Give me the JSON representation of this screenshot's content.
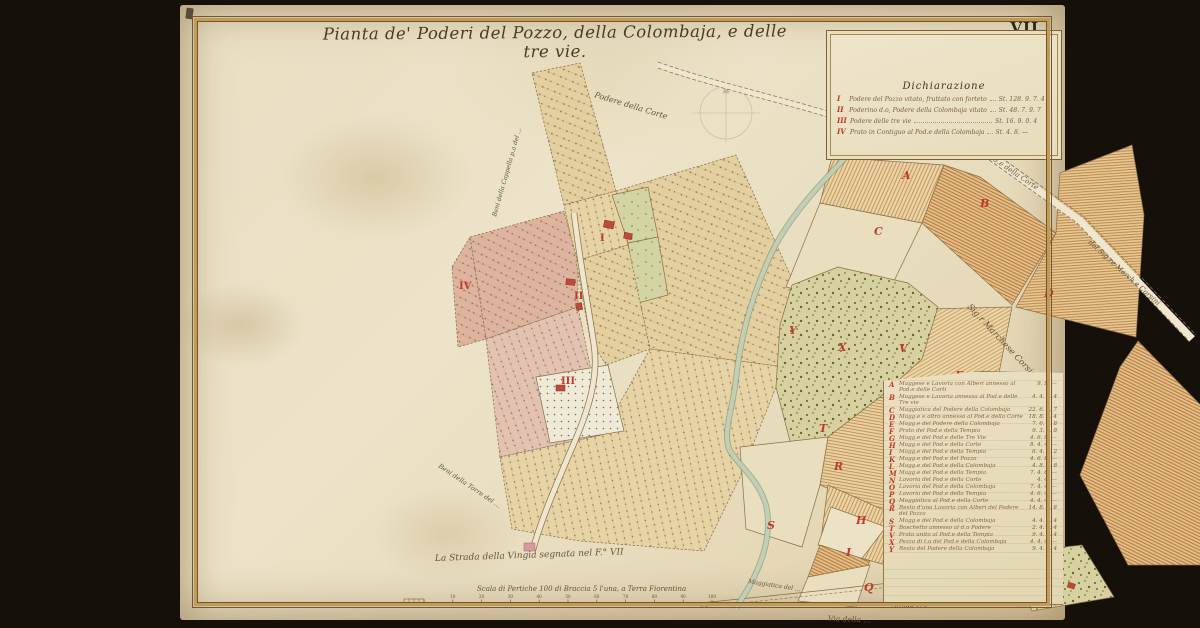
{
  "sheet": {
    "number": "VII",
    "title": "Pianta de' Poderi del Pozzo, della Colombaja, e delle tre vie."
  },
  "legend": {
    "title": "Dichiarazione",
    "entries": [
      {
        "numeral": "I",
        "text": "Podere del Pozzo vitato, fruttato con forteto &.",
        "value": "St. 128. 9. 7. 4"
      },
      {
        "numeral": "II",
        "text": "Poderino d.o, Podere della Colombaja vitato &.",
        "value": "St. 48. 7. 9. 7"
      },
      {
        "numeral": "III",
        "text": "Podere delle tre vie",
        "value": "St. 16. 9. 0. 4"
      },
      {
        "numeral": "IV",
        "text": "Prato in Contiguo al Pod.e della Colombaja",
        "value": "St. 4. 8. —"
      }
    ]
  },
  "index": {
    "entries": [
      {
        "letter": "A",
        "text": "Maggese e Lavoria con Alberi annesso al Pod.e delle Corti",
        "value": "9. 9. —"
      },
      {
        "letter": "B",
        "text": "Maggese e Lavoria annessa al Pod.e delle Tre vie",
        "value": "4. 4. 8. 4"
      },
      {
        "letter": "C",
        "text": "Maggiatica del Podere della Colombaja",
        "value": "22. 6. 2. 7"
      },
      {
        "letter": "D",
        "text": "Magg.e e altro annesso al Pod.e della Corte",
        "value": "18. 8. 6. 4"
      },
      {
        "letter": "E",
        "text": "Magg.e del Podere della Colombaja",
        "value": "7. 6. 8. 8"
      },
      {
        "letter": "F",
        "text": "Prato del Pod.e della Tempia",
        "value": "9. 3. 4. 8"
      },
      {
        "letter": "G",
        "text": "Magg.e del Pod.e delle Tre Vie",
        "value": "4. 6. 9. —"
      },
      {
        "letter": "H",
        "text": "Magg.e del Pod.e della Corte",
        "value": "8. 4. 4. —"
      },
      {
        "letter": "I",
        "text": "Magg.e del Pod.e della Tempia",
        "value": "6. 4. 2. 2"
      },
      {
        "letter": "K",
        "text": "Magg.e del Pod.e del Pozzo",
        "value": "4. 6. 8. —"
      },
      {
        "letter": "L",
        "text": "Magg.e del Pod.e della Colombaja",
        "value": "4. 8. 4. 8"
      },
      {
        "letter": "M",
        "text": "Magg.e del Pod.e della Tempia",
        "value": "7. 4. 6. —"
      },
      {
        "letter": "N",
        "text": "Lavoria del Pod.e della Corte",
        "value": "4. 4. —"
      },
      {
        "letter": "O",
        "text": "Lavoria del Pod.e della Colombaja",
        "value": "7. 4. 4. —"
      },
      {
        "letter": "P",
        "text": "Lavoria del Pod.e della Tempia",
        "value": "4. 6. 4. —"
      },
      {
        "letter": "Q",
        "text": "Maggiatica al Pod.e della Corte",
        "value": "4. 4. 4. —"
      },
      {
        "letter": "R",
        "text": "Resto d'una Lavoria con Alberi del Podere del Pozzo",
        "value": "14. 8. 9. 8"
      },
      {
        "letter": "S",
        "text": "Magg.e del Pod.e della Colombaja",
        "value": "4. 4. 4. 4"
      },
      {
        "letter": "T",
        "text": "Boschetto annesso al d.o Podere",
        "value": "2. 4. 4. 4"
      },
      {
        "letter": "V",
        "text": "Prato unito al Pod.e della Tempia",
        "value": "9. 4. 4. 4"
      },
      {
        "letter": "X",
        "text": "Pezzo di t.a del Pod.e della Colombaja",
        "value": "4. 4. 4. —"
      },
      {
        "letter": "Y",
        "text": "Resto del Podere della Colombaja",
        "value": "9. 4. 6. 4"
      }
    ]
  },
  "map": {
    "letters": [
      {
        "ch": "A",
        "x": 722,
        "y": 174
      },
      {
        "ch": "B",
        "x": 800,
        "y": 202
      },
      {
        "ch": "C",
        "x": 694,
        "y": 230
      },
      {
        "ch": "D",
        "x": 864,
        "y": 292
      },
      {
        "ch": "E",
        "x": 775,
        "y": 374
      },
      {
        "ch": "F",
        "x": 746,
        "y": 430
      },
      {
        "ch": "G",
        "x": 704,
        "y": 482
      },
      {
        "ch": "H",
        "x": 676,
        "y": 519
      },
      {
        "ch": "I",
        "x": 666,
        "y": 551
      },
      {
        "ch": "K",
        "x": 832,
        "y": 516
      },
      {
        "ch": "L",
        "x": 814,
        "y": 536
      },
      {
        "ch": "M",
        "x": 758,
        "y": 529
      },
      {
        "ch": "Q",
        "x": 684,
        "y": 586
      },
      {
        "ch": "R",
        "x": 654,
        "y": 465
      },
      {
        "ch": "S",
        "x": 587,
        "y": 524
      },
      {
        "ch": "T",
        "x": 639,
        "y": 427
      },
      {
        "ch": "V",
        "x": 719,
        "y": 347
      },
      {
        "ch": "X",
        "x": 658,
        "y": 346
      },
      {
        "ch": "Y",
        "x": 609,
        "y": 329
      }
    ],
    "numerals": [
      {
        "ch": "I",
        "x": 420,
        "y": 236,
        "size": 10
      },
      {
        "ch": "II",
        "x": 394,
        "y": 294,
        "size": 10
      },
      {
        "ch": "III",
        "x": 381,
        "y": 379,
        "size": 10
      },
      {
        "ch": "IV",
        "x": 279,
        "y": 284,
        "size": 8
      }
    ],
    "labels": [
      {
        "text": "Podere della Corte",
        "x": 414,
        "y": 92,
        "rot": 17,
        "size": 8
      },
      {
        "text": "Beni della Cappella p.a del …",
        "x": 316,
        "y": 212,
        "rot": -74,
        "size": 6.2
      },
      {
        "text": "Ansano",
        "x": 697,
        "y": 118,
        "rot": -62,
        "size": 6
      },
      {
        "text": "Maggiatica del Pod.e della Corte",
        "x": 760,
        "y": 120,
        "rot": 34,
        "size": 7
      },
      {
        "text": "del Sig.re March.e Corsini",
        "x": 908,
        "y": 238,
        "rot": 42,
        "size": 7
      },
      {
        "text": "Papini",
        "x": 758,
        "y": 146,
        "rot": 26,
        "size": 6.5
      },
      {
        "text": "Sig.r Marchese Corsini",
        "x": 787,
        "y": 302,
        "rot": 47,
        "size": 8.5
      },
      {
        "text": "Beni della Torre del …",
        "x": 258,
        "y": 462,
        "rot": 34,
        "size": 6.5
      },
      {
        "text": "La Strada della Vingia segnata nel F.° VII",
        "x": 255,
        "y": 556,
        "rot": -2,
        "size": 9
      },
      {
        "text": "Papini",
        "x": 752,
        "y": 578,
        "rot": 4,
        "size": 6.5
      },
      {
        "text": "La sua via di Ansano …",
        "x": 748,
        "y": 591,
        "rot": 4,
        "size": 5.5
      },
      {
        "text": "Strada segnata nel Foglio VII",
        "x": 712,
        "y": 603,
        "rot": -3,
        "size": 6.5,
        "color": "#a8563a"
      },
      {
        "text": "Maggiatica del …",
        "x": 568,
        "y": 578,
        "rot": 9,
        "size": 6
      },
      {
        "text": "Via della …",
        "x": 648,
        "y": 616,
        "rot": 2,
        "size": 7.5
      }
    ]
  },
  "scale": {
    "caption": "Scala di Pertiche 100 di Braccia 5 l'una, a Terra Fiorentina",
    "ticks": [
      "",
      "10",
      "20",
      "30",
      "40",
      "50",
      "60",
      "70",
      "80",
      "90",
      "100"
    ]
  }
}
